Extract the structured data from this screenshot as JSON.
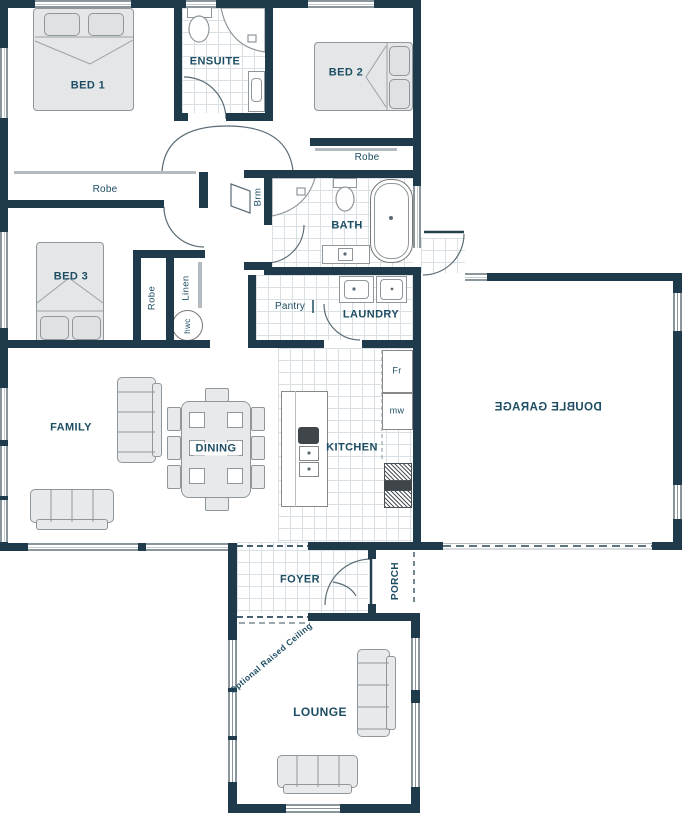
{
  "plan": {
    "rooms": {
      "bed1": "BED 1",
      "ensuite": "ENSUITE",
      "bed2": "BED 2",
      "bath": "BATH",
      "bed3": "BED 3",
      "pantry": "Pantry",
      "laundry": "LAUNDRY",
      "family": "FAMILY",
      "dining": "DINING",
      "kitchen": "KITCHEN",
      "garage": "DOUBLE GARAGE",
      "foyer": "FOYER",
      "porch": "PORCH",
      "lounge": "LOUNGE"
    },
    "storage": {
      "robe_bed1": "Robe",
      "robe_bed2": "Robe",
      "robe_bed3": "Robe",
      "linen": "Linen",
      "broom": "Brm",
      "hot_water": "hwc"
    },
    "appliances": {
      "fridge": "Fr",
      "microwave": "mw"
    },
    "annotations": {
      "optional_ceiling": "Optional Raised Ceiling"
    },
    "colors": {
      "wall": "#1f3a4b",
      "label_text": "#1d4d63",
      "furniture_fill": "#e7e9ea",
      "furniture_line": "#8f979c",
      "tile_line": "#d9e0e4"
    }
  }
}
